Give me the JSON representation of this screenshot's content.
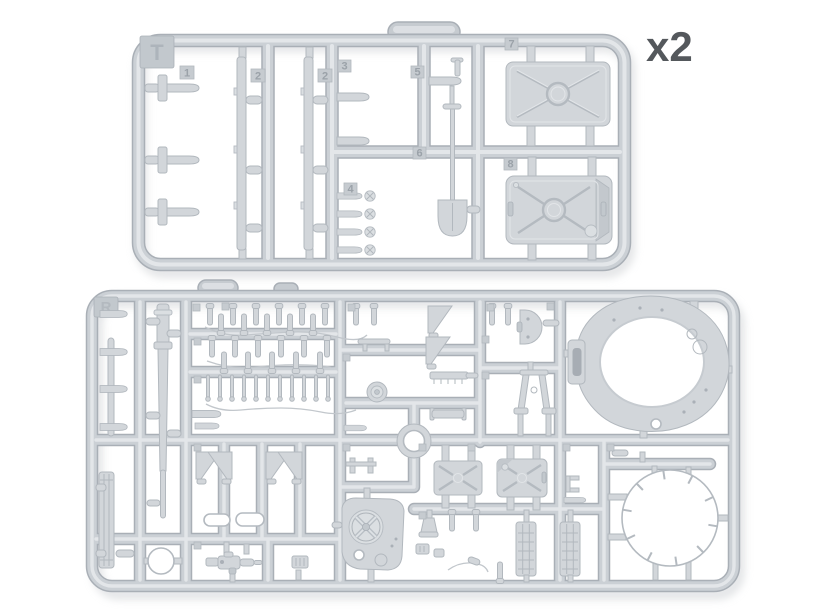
{
  "labels": {
    "quantity": "x2"
  },
  "top_sprue": {
    "tab_letter": "T",
    "part_numbers": {
      "p1": "1",
      "p2a": "2",
      "p2b": "2",
      "p3": "3",
      "p4": "4",
      "p5": "5",
      "p6": "6",
      "p7": "7",
      "p8": "8"
    }
  },
  "bottom_sprue": {
    "tab_letter": "R"
  },
  "colors": {
    "background": "#ffffff",
    "plastic": "#d2d6da",
    "plastic_highlight": "#e3e6e9",
    "plastic_shadow": "#a9afb6",
    "outline": "#b2b8be",
    "quantity_text": "#54585c",
    "emboss_text": "#9ba2a9"
  }
}
